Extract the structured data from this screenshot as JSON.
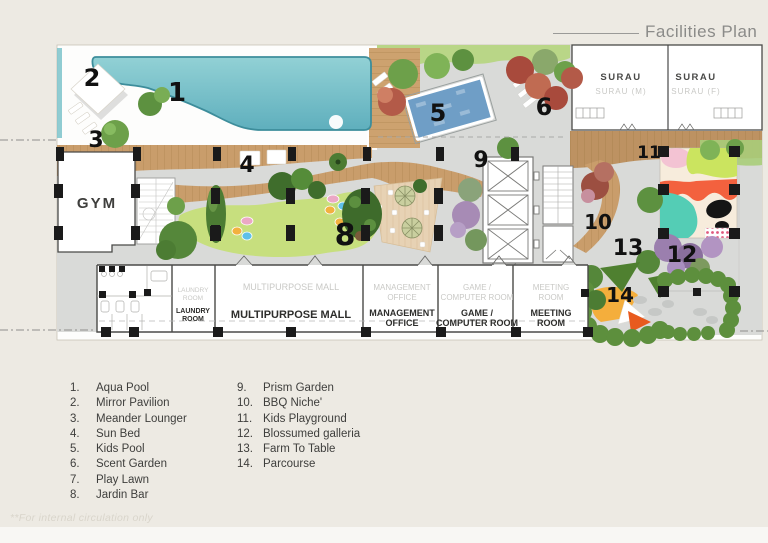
{
  "title": "Facilities Plan",
  "footnote": "**For internal circulation only",
  "plan": {
    "markers": {
      "n1": "1",
      "n2": "2",
      "n3": "3",
      "n4": "4",
      "n5": "5",
      "n6": "6",
      "n8": "8",
      "n9": "9",
      "n10": "10",
      "n11": "11",
      "n12": "12",
      "n13": "13",
      "n14": "14"
    },
    "rooms": {
      "gym": "GYM",
      "surau": "SURAU",
      "surau_m": "SURAU (M)",
      "surau_f": "SURAU (F)",
      "laundry1": "LAUNDRY",
      "laundry2": "ROOM",
      "mall": "MULTIPURPOSE MALL",
      "mgmt1": "MANAGEMENT",
      "mgmt2": "OFFICE",
      "game1": "GAME /",
      "game2": "COMPUTER ROOM",
      "meeting1": "MEETING",
      "meeting2": "ROOM"
    }
  },
  "legend": {
    "items": [
      {
        "num": "1.",
        "label": "Aqua Pool"
      },
      {
        "num": "2.",
        "label": "Mirror Pavilion"
      },
      {
        "num": "3.",
        "label": "Meander Lounger"
      },
      {
        "num": "4.",
        "label": "Sun Bed"
      },
      {
        "num": "5.",
        "label": "Kids Pool"
      },
      {
        "num": "6.",
        "label": "Scent Garden"
      },
      {
        "num": "7.",
        "label": "Play Lawn"
      },
      {
        "num": "8.",
        "label": "Jardin Bar"
      },
      {
        "num": "9.",
        "label": "Prism Garden"
      },
      {
        "num": "10.",
        "label": "BBQ Niche'"
      },
      {
        "num": "11.",
        "label": "Kids Playground"
      },
      {
        "num": "12.",
        "label": "Blossumed galleria"
      },
      {
        "num": "13.",
        "label": "Farm To Table"
      },
      {
        "num": "14.",
        "label": "Parcourse"
      }
    ]
  },
  "colors": {
    "background": "#edeae3",
    "pool_teal": "#7cc3ca",
    "kids_pool_blue": "#6f9ec6",
    "deck_wood": "#c99d6b",
    "lawn_green": "#c7df7e",
    "path_gray": "#d9dad8",
    "hedge_green": "#5d8f3d",
    "red_tree": "#b35a48",
    "purple_tree": "#9b7fae",
    "playground_teal": "#54cdb5",
    "playground_orange": "#f3613e",
    "playground_lime": "#cbe45f",
    "parcourse_orange": "#f4ae3c",
    "column_black": "#1a1a1a"
  }
}
